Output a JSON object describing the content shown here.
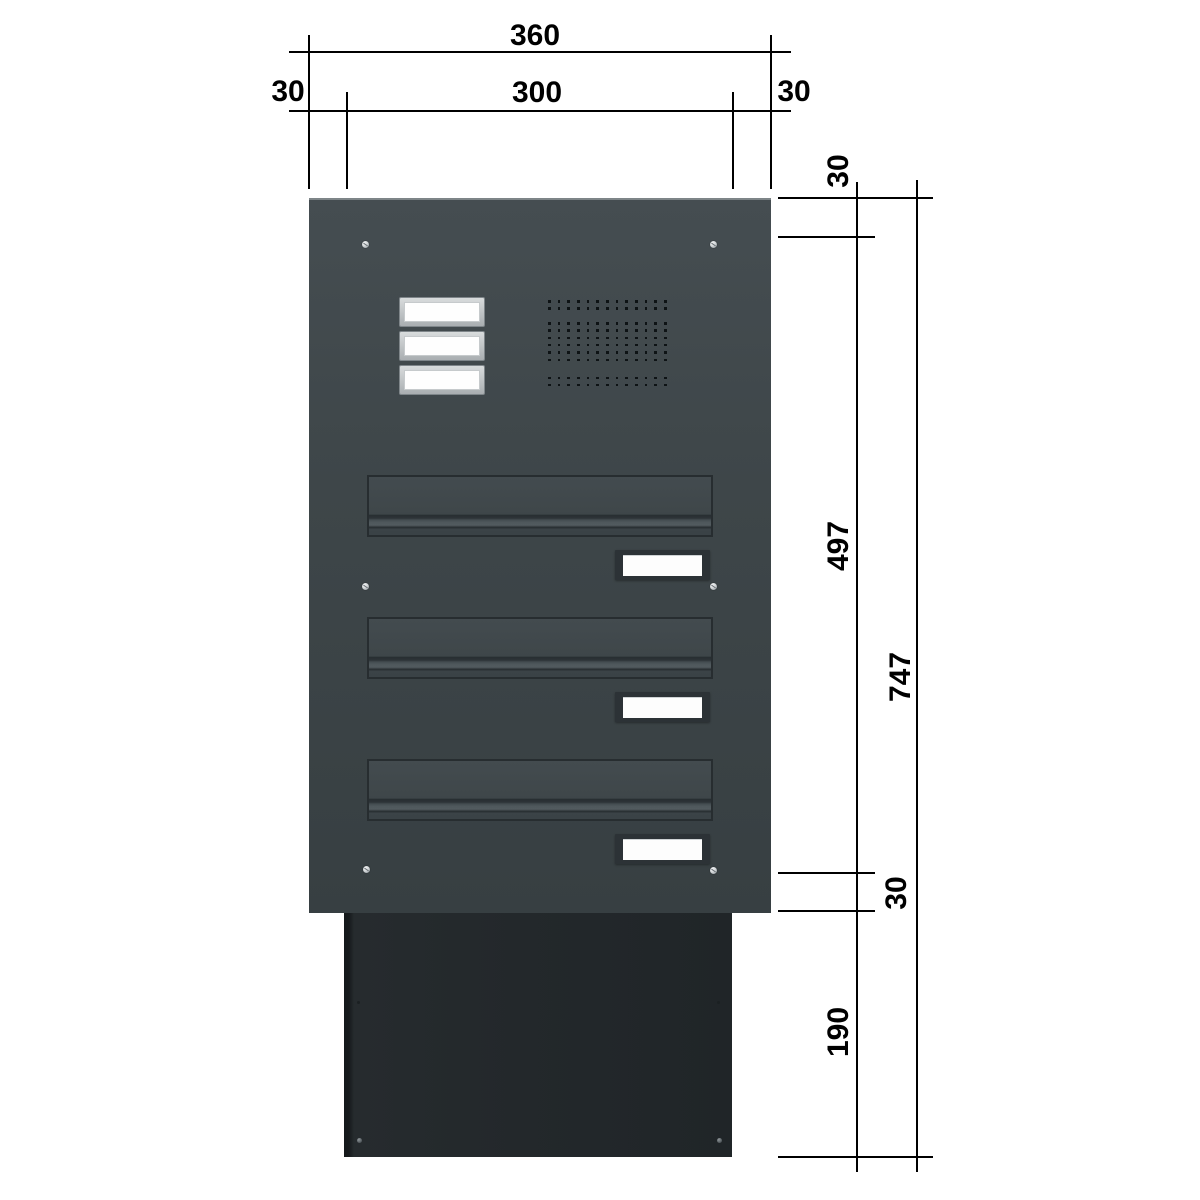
{
  "drawing": {
    "kind": "technical dimension drawing",
    "subject": "wall pass-through letterbox unit with bell panel, intercom speaker grille and 3 mail flaps",
    "units": "mm"
  },
  "dims": {
    "total_width": "360",
    "left_margin": "30",
    "inner_width": "300",
    "right_margin": "30",
    "top_margin": "30",
    "panel_body_height": "497",
    "total_height": "747",
    "bottom_margin": "30",
    "duct_height": "190"
  },
  "components": {
    "bell_plate_count": 3,
    "mail_flap_count": 3,
    "name_plate_count": 3,
    "panel_screw_count": 6,
    "duct_screw_count": 2
  },
  "speaker": {
    "columns": 13,
    "row_groups": [
      2,
      6,
      2
    ]
  },
  "colors": {
    "line": "#000000",
    "panel": "#3c4447",
    "panel_edge": "#7e8588",
    "duct": "#23282b",
    "flap_border": "#272d30",
    "plate_frame": "#2c3236",
    "plate_white": "#fdfdfd",
    "bell_white": "#fefefe",
    "speaker_dot": "#0e1315",
    "background": "#ffffff"
  }
}
